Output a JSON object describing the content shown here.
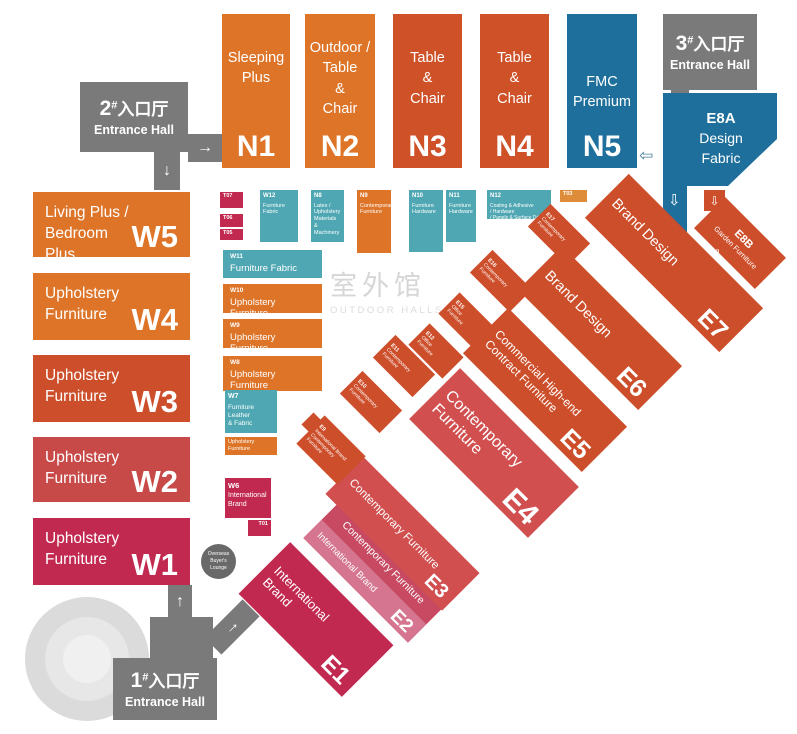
{
  "watermark": {
    "cn": "室外馆",
    "en": "OUTDOOR HALLS"
  },
  "entrances": {
    "one": {
      "num": "1",
      "hash": "#",
      "cn": "入口厅",
      "en": "Entrance Hall"
    },
    "two": {
      "num": "2",
      "hash": "#",
      "cn": "入口厅",
      "en": "Entrance Hall"
    },
    "three": {
      "num": "3",
      "hash": "#",
      "cn": "入口厅",
      "en": "Entrance Hall"
    }
  },
  "lounge": {
    "text": "Overseas\nBuyer's\nLounge"
  },
  "arrows": {
    "right": "→",
    "down": "↓",
    "up": "↑",
    "left_hollow": "⇦",
    "down_hollow": "⇩"
  },
  "halls": {
    "n1": {
      "code": "N1",
      "label": "Sleeping\nPlus"
    },
    "n2": {
      "code": "N2",
      "label": "Outdoor /\nTable\n&\nChair"
    },
    "n3": {
      "code": "N3",
      "label": "Table\n&\nChair"
    },
    "n4": {
      "code": "N4",
      "label": "Table\n&\nChair"
    },
    "n5": {
      "code": "N5",
      "label": "FMC\nPremium"
    },
    "w5": {
      "code": "W5",
      "label": "Living Plus /\nBedroom Plus"
    },
    "w4": {
      "code": "W4",
      "label": "Upholstery\nFurniture"
    },
    "w3": {
      "code": "W3",
      "label": "Upholstery\nFurniture"
    },
    "w2": {
      "code": "W2",
      "label": "Upholstery\nFurniture"
    },
    "w1": {
      "code": "W1",
      "label": "Upholstery\nFurniture"
    },
    "w12": {
      "code": "W12",
      "label": "Furniture\nFabric"
    },
    "n8": {
      "code": "N8",
      "label": "Latex /\nUpholstery\nMaterials &\nMachinery"
    },
    "n9": {
      "code": "N9",
      "label": "Contemporary\nFurniture"
    },
    "n10": {
      "code": "N10",
      "label": "Furniture\nHardware"
    },
    "n11": {
      "code": "N11",
      "label": "Furniture\nHardware"
    },
    "n12": {
      "code": "N12",
      "label": "Coating & Adhesive\n/ Hardware\n/ Panels & Surface Décor"
    },
    "w11": {
      "code": "W11",
      "label": "Furniture  Fabric"
    },
    "w10": {
      "code": "W10",
      "label": "Upholstery Furniture"
    },
    "w9": {
      "code": "W9",
      "label": "Upholstery Furniture"
    },
    "w8": {
      "code": "W8",
      "label": "Upholstery Furniture"
    },
    "w7": {
      "code": "W7",
      "label": "Furniture Leather\n& Fabric"
    },
    "w7_strip": {
      "label": "Upholstery Furniture"
    },
    "w6": {
      "code": "W6",
      "label": "International\nBrand"
    },
    "t01": {
      "code": "T01"
    },
    "t03": {
      "code": "T03"
    },
    "t05": {
      "code": "T05"
    },
    "t06": {
      "code": "T06"
    },
    "t07": {
      "code": "T07"
    },
    "e1": {
      "code": "E1",
      "label": "International\nBrand"
    },
    "e2": {
      "code": "E2",
      "label_top": "Contemporary Furniture",
      "label_bottom": "International Brand"
    },
    "e3": {
      "code": "E3",
      "label": "Contemporary Furniture"
    },
    "e4": {
      "code": "E4",
      "label": "Contemporary\nFurniture"
    },
    "e5": {
      "code": "E5",
      "label": "Commercial High-end\nContract Furniture"
    },
    "e6": {
      "code": "E6",
      "label": "Brand Design"
    },
    "e7": {
      "code": "E7",
      "label": "Brand Design"
    },
    "e8a": {
      "code": "E8A",
      "label": "Design\nFabric"
    },
    "e8b": {
      "code": "E8B",
      "label": "Garden Furniture"
    },
    "e9": {
      "code": "E9",
      "label": "International Brand\nContemporary Furniture"
    },
    "e10": {
      "code": "E10",
      "label": "Contemporary\nFurniture"
    },
    "e11": {
      "code": "E11",
      "label": "Contemporary\nFurniture"
    },
    "e12": {
      "code": "E12",
      "label": "Office\nFurniture"
    },
    "e15": {
      "code": "E15",
      "label": "Office\nFurniture"
    },
    "e16": {
      "code": "E16",
      "label": "Contemporary\nFurniture"
    },
    "e17": {
      "code": "E17",
      "label": "Contemporary\nFurniture"
    }
  },
  "colors": {
    "orange": "#DD7428",
    "orange_light": "#DF8C3A",
    "rust": "#CD4E2A",
    "red": "#D14F4F",
    "red_dark": "#C74A49",
    "crimson": "#C22950",
    "rose": "#C74A62",
    "rose_stripe": "#D5758F",
    "teal": "#4EA7B2",
    "blue": "#1F6F9C",
    "gray": "#7A7A7A",
    "lounge_gray": "#696969",
    "watermark_gray": "#D6D6D6"
  }
}
